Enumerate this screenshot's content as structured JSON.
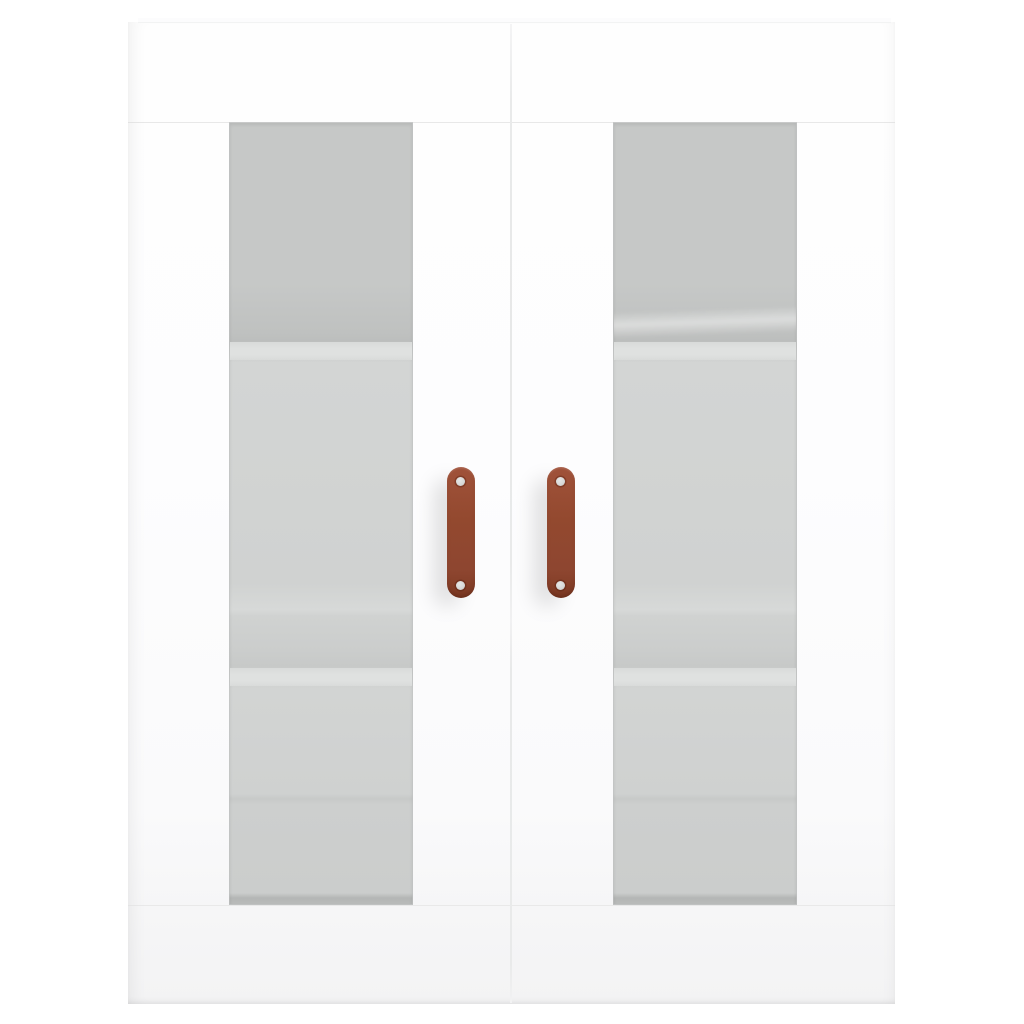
{
  "scene": {
    "type": "product-photo",
    "subject": "White wall-mounted cabinet with two glass-panel doors, interior shelves and brown handles",
    "background_color": "#ffffff"
  },
  "cabinet": {
    "body_color": "#fdfdfe",
    "seam_color": "#e9eaea",
    "handle_color": "#93492f",
    "handle_shadow_color": "#7e3a23",
    "screw_color": "#d8d9d8",
    "doors": [
      {
        "id": "left-door",
        "glass_panel": true,
        "handle_screws": 2
      },
      {
        "id": "right-door",
        "glass_panel": true,
        "handle_screws": 2
      }
    ],
    "glass": {
      "tint_top": "#c6c8c7",
      "tint_mid": "#d0d2d1",
      "shelf_edge_color": "#dfe1e0",
      "bottom_edge_color": "#b4b6b5",
      "shelves_visible_per_door": 2
    }
  }
}
